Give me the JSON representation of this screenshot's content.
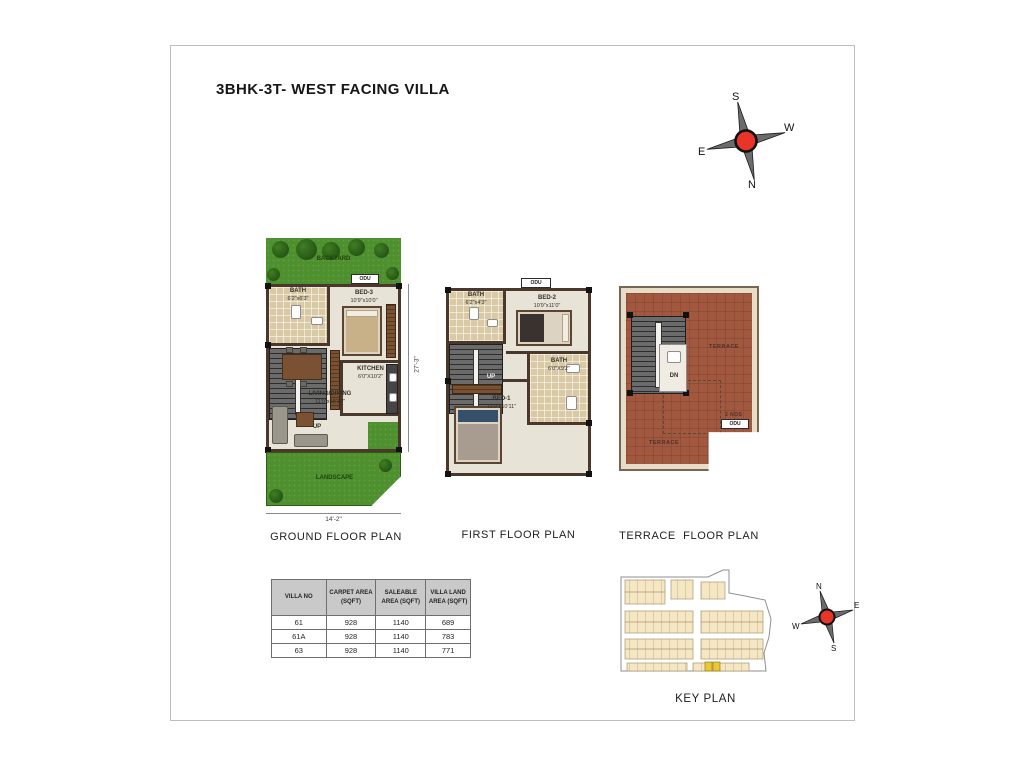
{
  "page": {
    "title": "3BHK-3T- WEST FACING VILLA"
  },
  "colors": {
    "compass_center": "#e83528",
    "grass": "#4e8f2e",
    "terrace_tile": "#a2573f",
    "bath_tile": "#d9c9a5",
    "wall": "#4a382c",
    "table_header_bg": "#c9c9c9",
    "keyplan_plot": "#f5e7c4",
    "keyplan_highlight": "#eac832"
  },
  "compass_main": {
    "top": "S",
    "right": "W",
    "left": "E",
    "bottom": "N"
  },
  "compass_key": {
    "top": "N",
    "right": "E",
    "left": "W",
    "bottom": "S"
  },
  "ground_floor": {
    "title": "GROUND FLOOR PLAN",
    "backyard_label": "BACKYARD",
    "odu_label": "ODU",
    "bath_name": "BATH",
    "bath_size": "6'2\"x6'3\"",
    "bed3_name": "BED-3",
    "bed3_size": "10'9\"x10'0\"",
    "up_label": "UP",
    "kitchen_name": "KITCHEN",
    "kitchen_size": "6'0\"X10'2\"",
    "living_name": "LIVING/DINING",
    "living_size": "11'0\"x15'10\"",
    "landscape_label": "LANDSCAPE",
    "dim_width": "14'-2\"",
    "dim_height": "27'-3\""
  },
  "first_floor": {
    "title": "FIRST FLOOR PLAN",
    "odu_label": "ODU",
    "bath_top_name": "BATH",
    "bath_top_size": "6'2\"x4'3\"",
    "bed2_name": "BED-2",
    "bed2_size": "10'9\"x11'0\"",
    "up_label": "UP",
    "bed1_name": "BED-1",
    "bed1_size": "11'0\"x10'11\"",
    "bath_bottom_name": "BATH",
    "bath_bottom_size": "6'0\"X9'2\""
  },
  "terrace_floor": {
    "title": "TERRACE  FLOOR PLAN",
    "terrace_label_upper": "TERRACE",
    "terrace_label_lower": "TERRACE",
    "dn_label": "DN",
    "odu_qty": "2 NOS",
    "odu_label": "ODU"
  },
  "area_table": {
    "headers": [
      "VILLA NO",
      "CARPET AREA (SQFT)",
      "SALEABLE AREA (SQFT)",
      "VILLA LAND AREA (SQFT)"
    ],
    "rows": [
      [
        "61",
        "928",
        "1140",
        "689"
      ],
      [
        "61A",
        "928",
        "1140",
        "783"
      ],
      [
        "63",
        "928",
        "1140",
        "771"
      ]
    ]
  },
  "key_plan": {
    "title": "KEY PLAN"
  }
}
